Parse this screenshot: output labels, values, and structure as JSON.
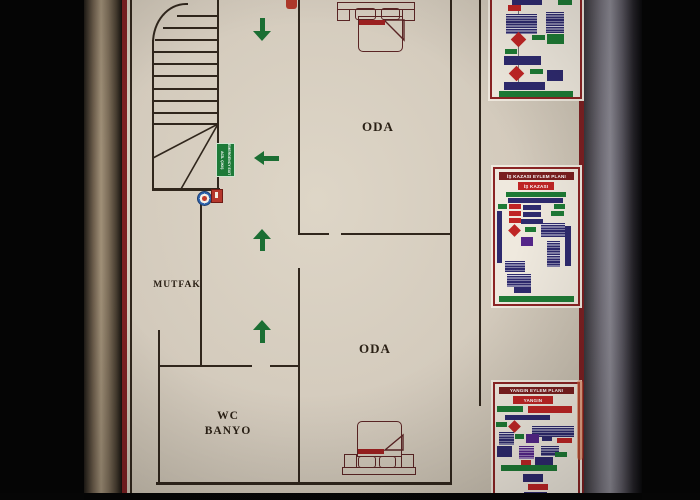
{
  "scene_title": "Apartment evacuation floor plan board",
  "floor_plan": {
    "rooms": [
      {
        "label": "ODA",
        "position": "top-right"
      },
      {
        "label": "ODA",
        "position": "bottom-right"
      },
      {
        "label": "MUTFAK",
        "position": "middle-left"
      }
    ],
    "wc_banyo": {
      "line1": "WC",
      "line2": "BANYO"
    },
    "exit_sign": {
      "line1": "ACİL ÇIKIŞ",
      "line2": "EMERGENCY EXIT",
      "color": "#1d7a38"
    },
    "colors": {
      "wall": "#30261c",
      "paper": "#d5ccbc",
      "arrow_green": "#1b6e33",
      "bed_outline": "#5a2424",
      "blanket_red": "#9c2020"
    }
  },
  "action_plans": {
    "accident": {
      "title": "İŞ KAZASI EYLEM PLANI",
      "subtitle": "İŞ KAZASI"
    },
    "fire": {
      "title": "YANGIN EYLEM PLANI",
      "subtitle": "YANGIN"
    },
    "colors": {
      "banner": "#7a1f1f",
      "node_red": "#bf2525",
      "node_green": "#1e7a35",
      "node_navy": "#2e2a6e",
      "node_purple": "#55268a",
      "border": "#8b2424"
    }
  },
  "icons": {
    "exit_route_arrows": "green-arrow-icon",
    "assembly_marker": "assembly-point-icon",
    "extinguisher_marker": "fire-extinguisher-icon"
  },
  "board": {
    "border_color": "#7c2022",
    "frame": "metal-wood"
  }
}
